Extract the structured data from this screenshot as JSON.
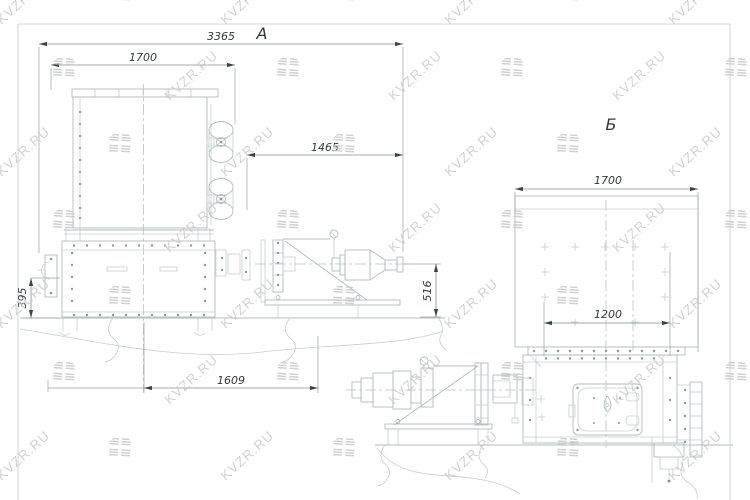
{
  "watermark": {
    "text": "KVZR.RU",
    "logo_icon": "kvzr-diagonal-hatch-logo"
  },
  "views": {
    "a": {
      "label": "А",
      "dims": {
        "overall_width": "3365",
        "cooler_width": "1700",
        "drive_reach": "1465",
        "frame_height": "395",
        "drive_axis_height": "516",
        "base_length": "1609"
      }
    },
    "b": {
      "label": "Б",
      "dims": {
        "cooler_width": "1700",
        "flange_span": "1200"
      }
    }
  }
}
